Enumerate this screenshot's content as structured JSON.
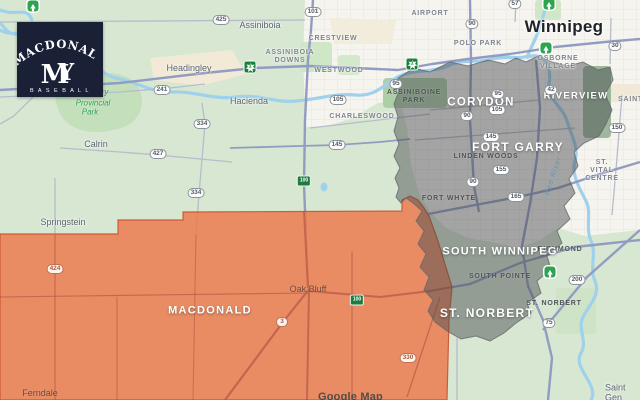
{
  "logo": {
    "team_name": "MACDONALD",
    "monogram_m": "M",
    "monogram_y": "Y",
    "subtitle": "B A S E B A L L",
    "bg_color": "#1a2137"
  },
  "map": {
    "city": {
      "name": "Winnipeg"
    },
    "watermark": "Google Map",
    "river_label": "Red River",
    "park_label": {
      "line1": "ry",
      "line2": "Provincial",
      "line3": "Park"
    },
    "overlays": {
      "macdonald_region_color": "#ee7549",
      "winnipeg_region_color": "#474a4e"
    },
    "regions": [
      {
        "name": "MACDONALD"
      },
      {
        "name": "CORYDON"
      },
      {
        "name": "FORT GARRY"
      },
      {
        "name": "SOUTH WINNIPEG"
      },
      {
        "name": "ST. NORBERT"
      },
      {
        "name": "RIVERVIEW"
      }
    ],
    "towns": [
      {
        "name": "Assiniboia"
      },
      {
        "name": "Headingley"
      },
      {
        "name": "Hacienda"
      },
      {
        "name": "Calrin"
      },
      {
        "name": "Springstein"
      },
      {
        "name": "Oak Bluff"
      },
      {
        "name": "Ferndale"
      },
      {
        "name": "Saint Gen"
      }
    ],
    "neighborhoods": [
      {
        "name": "CRESTVIEW"
      },
      {
        "name": "ASSINIBOIA\nDOWNS"
      },
      {
        "name": "WESTWOOD"
      },
      {
        "name": "CHARLESWOOD"
      },
      {
        "name": "POLO PARK"
      },
      {
        "name": "AIRPORT"
      },
      {
        "name": "OSBORNE\nVILLAGE"
      },
      {
        "name": "ASSINIBOINE\nPARK"
      },
      {
        "name": "LINDEN WOODS"
      },
      {
        "name": "FORT WHYTE"
      },
      {
        "name": "ST. VITAL CENTRE"
      },
      {
        "name": "RICHMOND"
      },
      {
        "name": "SOUTH POINTE"
      },
      {
        "name": "ST. NORBERT"
      },
      {
        "name": "SAINT"
      }
    ],
    "route_shields": [
      {
        "num": "425"
      },
      {
        "num": "101"
      },
      {
        "num": "241"
      },
      {
        "num": "334"
      },
      {
        "num": "427"
      },
      {
        "num": "334"
      },
      {
        "num": "145"
      },
      {
        "num": "105"
      },
      {
        "num": "95"
      },
      {
        "num": "57"
      },
      {
        "num": "90"
      },
      {
        "num": "30"
      },
      {
        "num": "95"
      },
      {
        "num": "105"
      },
      {
        "num": "90"
      },
      {
        "num": "145"
      },
      {
        "num": "155"
      },
      {
        "num": "90"
      },
      {
        "num": "165"
      },
      {
        "num": "150"
      },
      {
        "num": "42"
      },
      {
        "num": "200"
      },
      {
        "num": "75"
      },
      {
        "num": "424"
      },
      {
        "num": "3"
      },
      {
        "num": "330"
      }
    ],
    "tch_shields": [
      {
        "num": "1"
      },
      {
        "num": "1"
      }
    ],
    "pth_shields": [
      {
        "num": "100"
      },
      {
        "num": "100"
      }
    ],
    "icons": {
      "park_icon": "tree-icon",
      "tch_icon": "trans-canada-leaf-shield",
      "pth_icon": "perimeter-highway-shield"
    }
  }
}
